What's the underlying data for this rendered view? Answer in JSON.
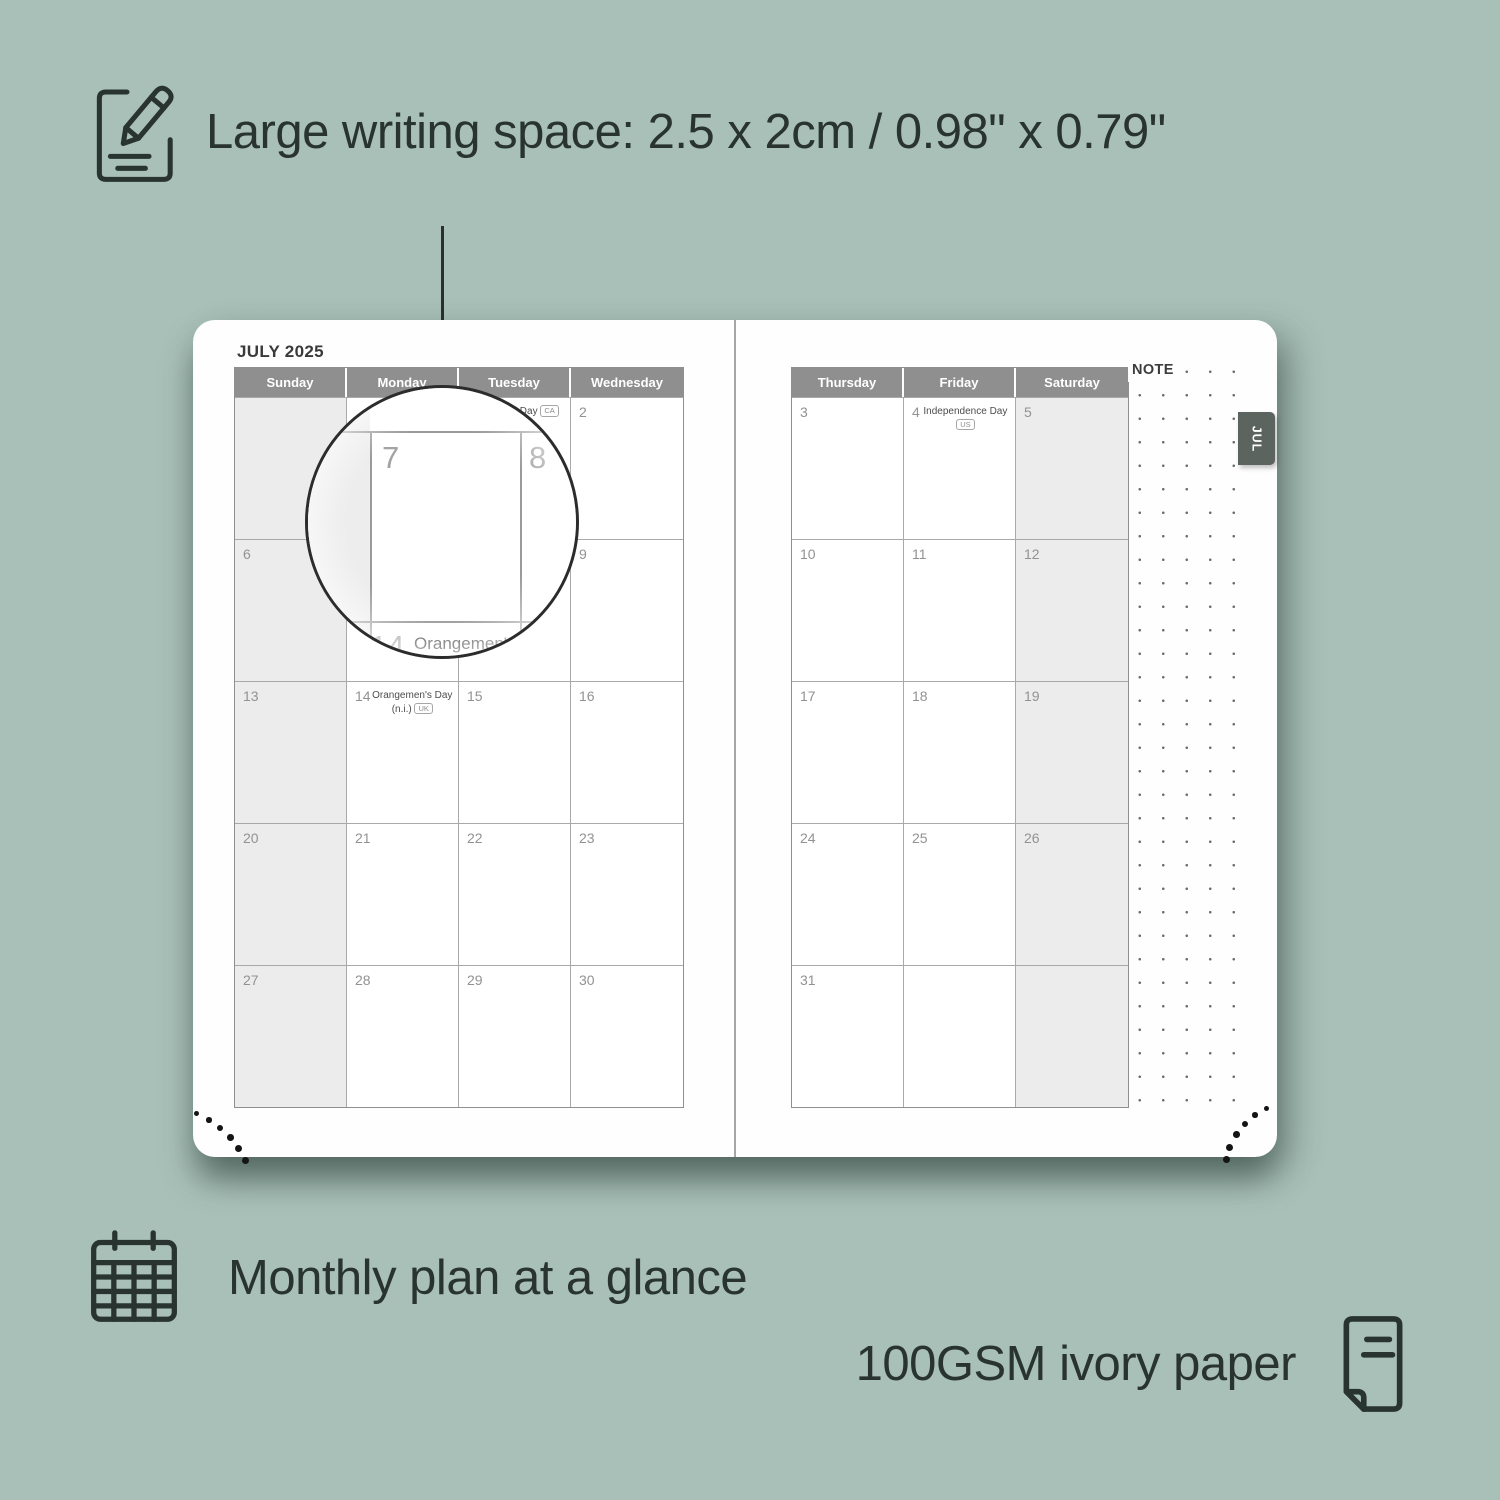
{
  "features": {
    "top": {
      "icon": "pencil-notepad-icon",
      "text": "Large writing space: 2.5 x 2cm / 0.98\" x 0.79\""
    },
    "bottom_left": {
      "icon": "calendar-grid-icon",
      "text": "Monthly plan at a glance"
    },
    "bottom_right": {
      "icon": "paper-sheet-icon",
      "text": "100GSM ivory paper"
    }
  },
  "planner": {
    "title": "JULY 2025",
    "tab": "JUL",
    "note_label": "NOTE",
    "left_page": {
      "headers": [
        "Sunday",
        "Monday",
        "Tuesday",
        "Wednesday"
      ],
      "weekend_col": 0,
      "rows": [
        [
          {
            "day": ""
          },
          {
            "day": ""
          },
          {
            "day": "1",
            "holiday": {
              "name": "Canada Day",
              "badge": "CA",
              "inline": true
            }
          },
          {
            "day": "2"
          }
        ],
        [
          {
            "day": "6"
          },
          {
            "day": "7"
          },
          {
            "day": "8"
          },
          {
            "day": "9"
          }
        ],
        [
          {
            "day": "13"
          },
          {
            "day": "14",
            "holiday": {
              "name": "Orangemen's Day",
              "sub": "(n.i.)",
              "badge": "UK",
              "inline": false
            }
          },
          {
            "day": "15"
          },
          {
            "day": "16"
          }
        ],
        [
          {
            "day": "20"
          },
          {
            "day": "21"
          },
          {
            "day": "22"
          },
          {
            "day": "23"
          }
        ],
        [
          {
            "day": "27"
          },
          {
            "day": "28"
          },
          {
            "day": "29"
          },
          {
            "day": "30"
          }
        ]
      ]
    },
    "right_page": {
      "headers": [
        "Thursday",
        "Friday",
        "Saturday"
      ],
      "weekend_col": 2,
      "rows": [
        [
          {
            "day": "3"
          },
          {
            "day": "4",
            "holiday": {
              "name": "Independence Day",
              "sub": "",
              "badge": "US",
              "inline": false
            }
          },
          {
            "day": "5"
          }
        ],
        [
          {
            "day": "10"
          },
          {
            "day": "11"
          },
          {
            "day": "12"
          }
        ],
        [
          {
            "day": "17"
          },
          {
            "day": "18"
          },
          {
            "day": "19"
          }
        ],
        [
          {
            "day": "24"
          },
          {
            "day": "25"
          },
          {
            "day": "26"
          }
        ],
        [
          {
            "day": "31"
          },
          {
            "day": ""
          },
          {
            "day": ""
          }
        ]
      ]
    }
  },
  "magnifier": {
    "day_left": "7",
    "day_right": "8",
    "next_day": "14",
    "next_holiday": "Orangemen's Day",
    "next_sub": "(n.i.)",
    "next_badge": "UK"
  },
  "colors": {
    "background": "#a8c0b8",
    "text_dark": "#293430",
    "header_bg": "#8f8f8f",
    "weekend_bg": "#ececec",
    "tab_bg": "#5c6460",
    "page_bg": "#fefefe"
  }
}
